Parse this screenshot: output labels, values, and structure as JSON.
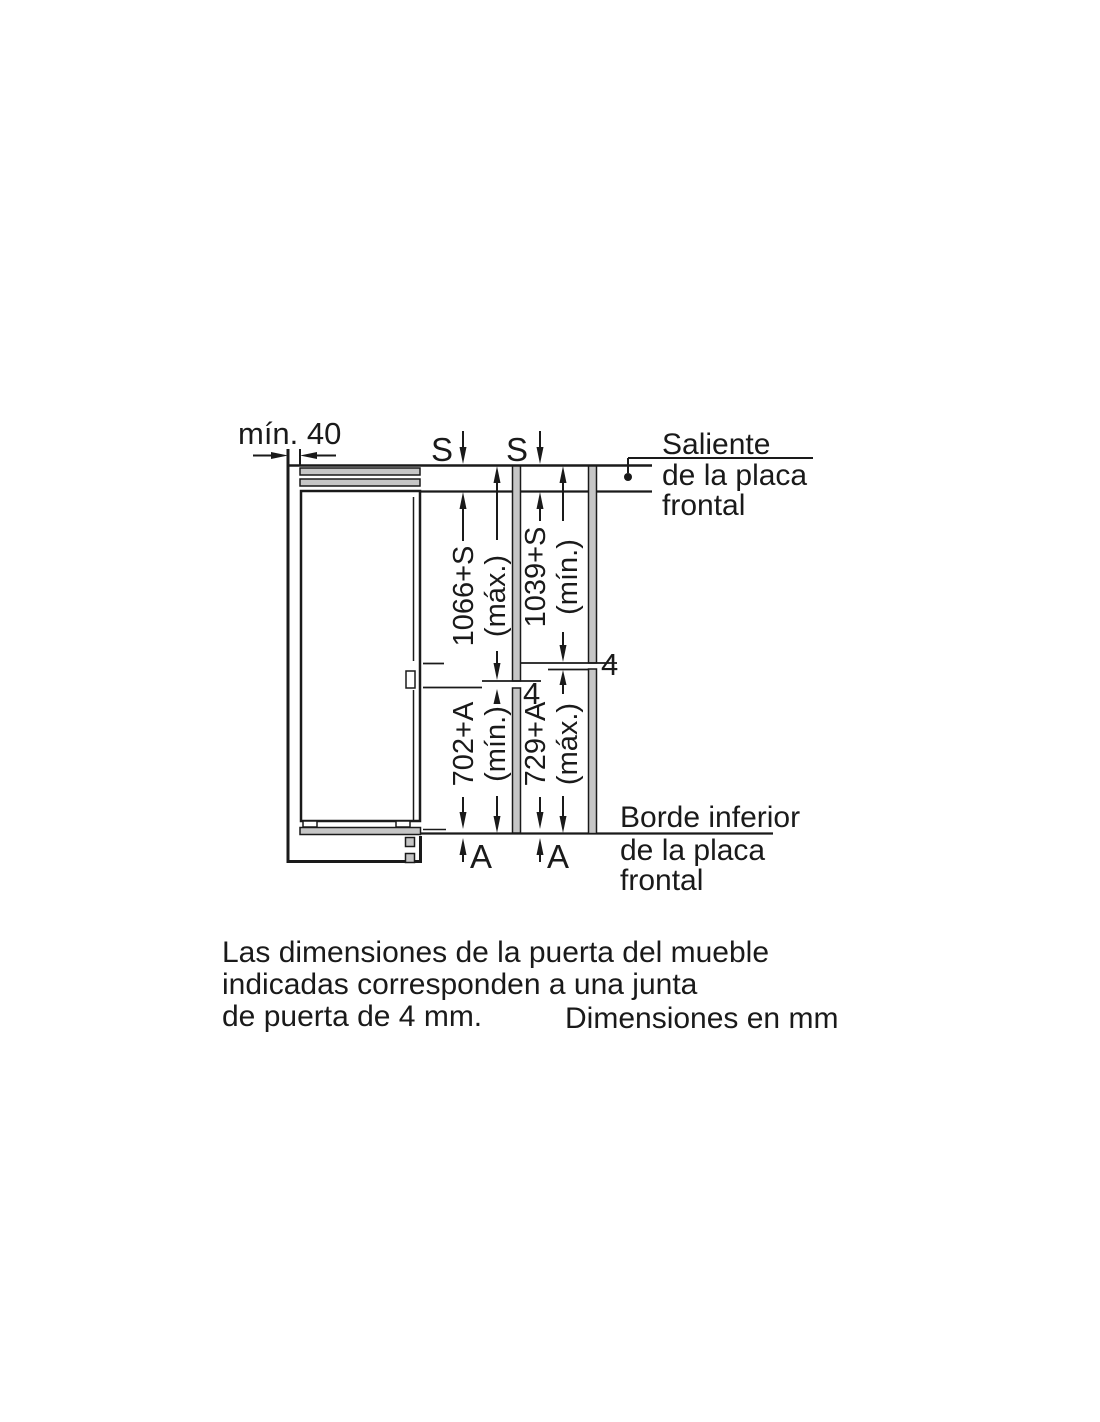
{
  "diagram": {
    "min_gap_label": "mín. 40",
    "s_labels": [
      "S",
      "S"
    ],
    "a_labels": [
      "A",
      "A"
    ],
    "gap_labels": {
      "left": "4",
      "right": "4"
    },
    "dims": {
      "upper_left": {
        "value": "1066+S",
        "qualifier": "(máx.)"
      },
      "upper_right": {
        "value": "1039+S",
        "qualifier": "(mín.)"
      },
      "lower_left": {
        "value": "702+A",
        "qualifier": "(mín.)"
      },
      "lower_right": {
        "value": "729+A",
        "qualifier": "(máx.)"
      }
    },
    "callout_top": {
      "line1": "Saliente",
      "line2": "de la placa",
      "line3": "frontal"
    },
    "callout_bottom": {
      "line1": "Borde inferior",
      "line2": "de la placa",
      "line3": "frontal"
    }
  },
  "caption": {
    "line1": "Las dimensiones de la puerta del mueble",
    "line2": "indicadas corresponden a una junta",
    "line3": "de puerta de 4 mm.",
    "units_note": "Dimensiones en mm"
  },
  "colors": {
    "line": "#1a1a1a",
    "panel_fill": "#c6c6c6",
    "background": "#ffffff"
  }
}
